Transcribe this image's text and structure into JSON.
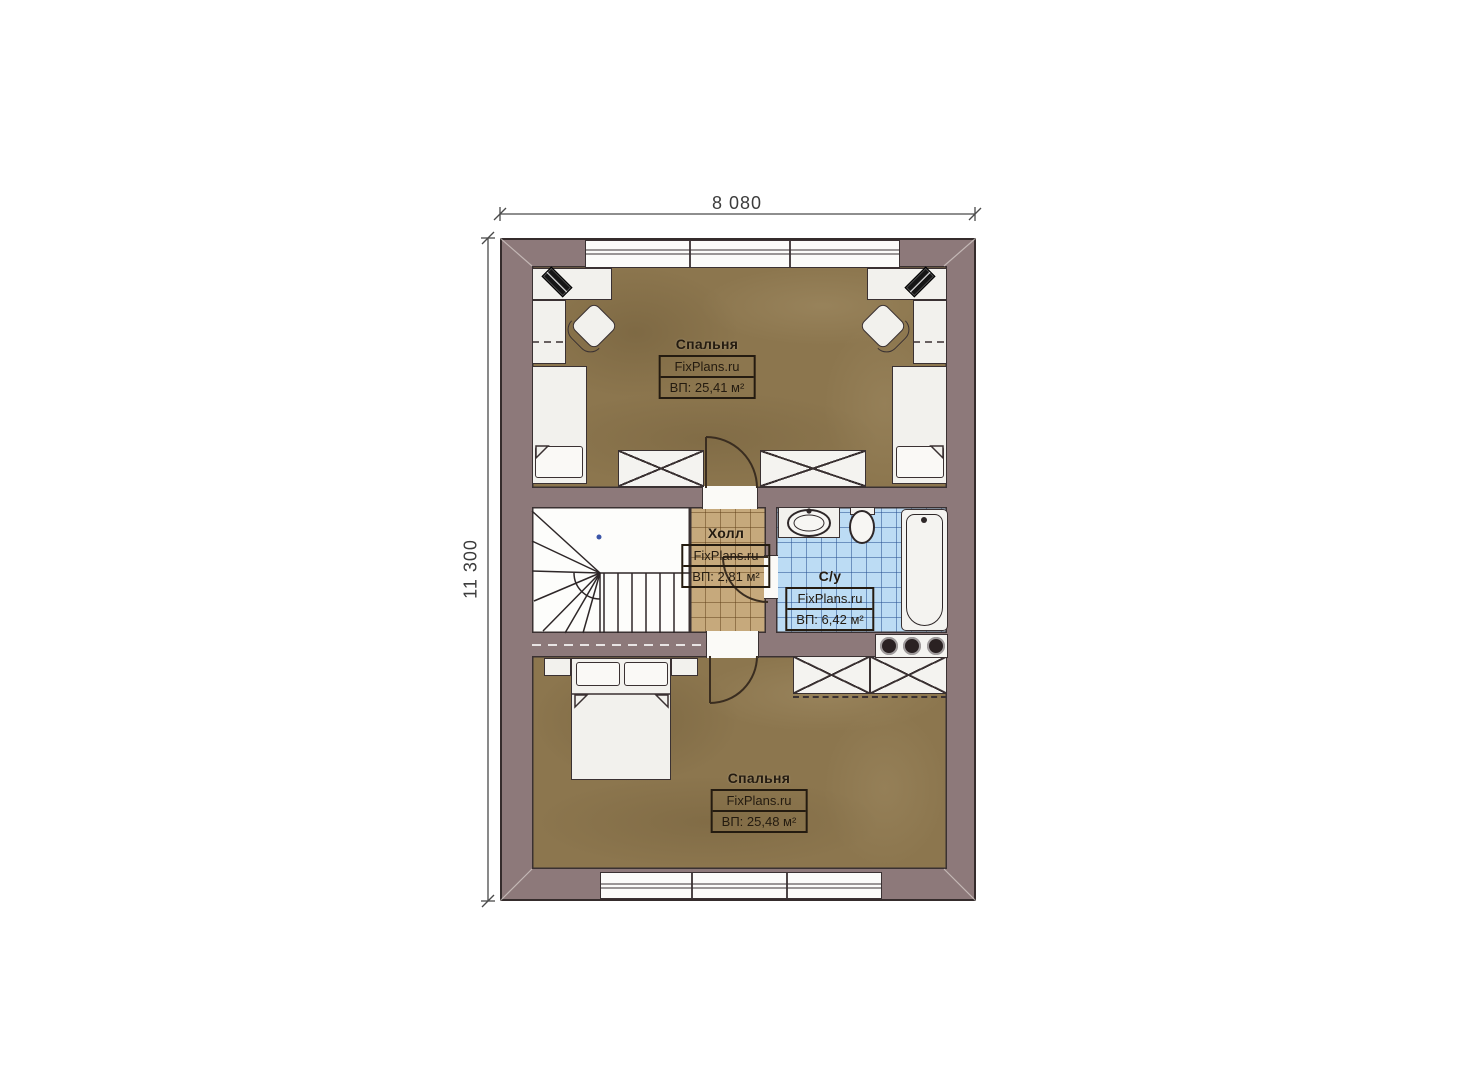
{
  "dimensions": {
    "width": "8 080",
    "height": "11 300"
  },
  "rooms": [
    {
      "name": "Спальня",
      "brand": "FixPlans.ru",
      "area": "ВП: 25,41 м²"
    },
    {
      "name": "Холл",
      "brand": "FixPlans.ru",
      "area": "ВП: 2,81 м²"
    },
    {
      "name": "С/у",
      "brand": "FixPlans.ru",
      "area": "ВП: 6,42 м²"
    },
    {
      "name": "Спальня",
      "brand": "FixPlans.ru",
      "area": "ВП: 25,48 м²"
    }
  ],
  "colors": {
    "wall": "#8d797a",
    "wood_floor": "#8c764e",
    "hall_tile": "#c6a97c",
    "bath_tile": "#bcdcf4",
    "line": "#352c2c"
  }
}
